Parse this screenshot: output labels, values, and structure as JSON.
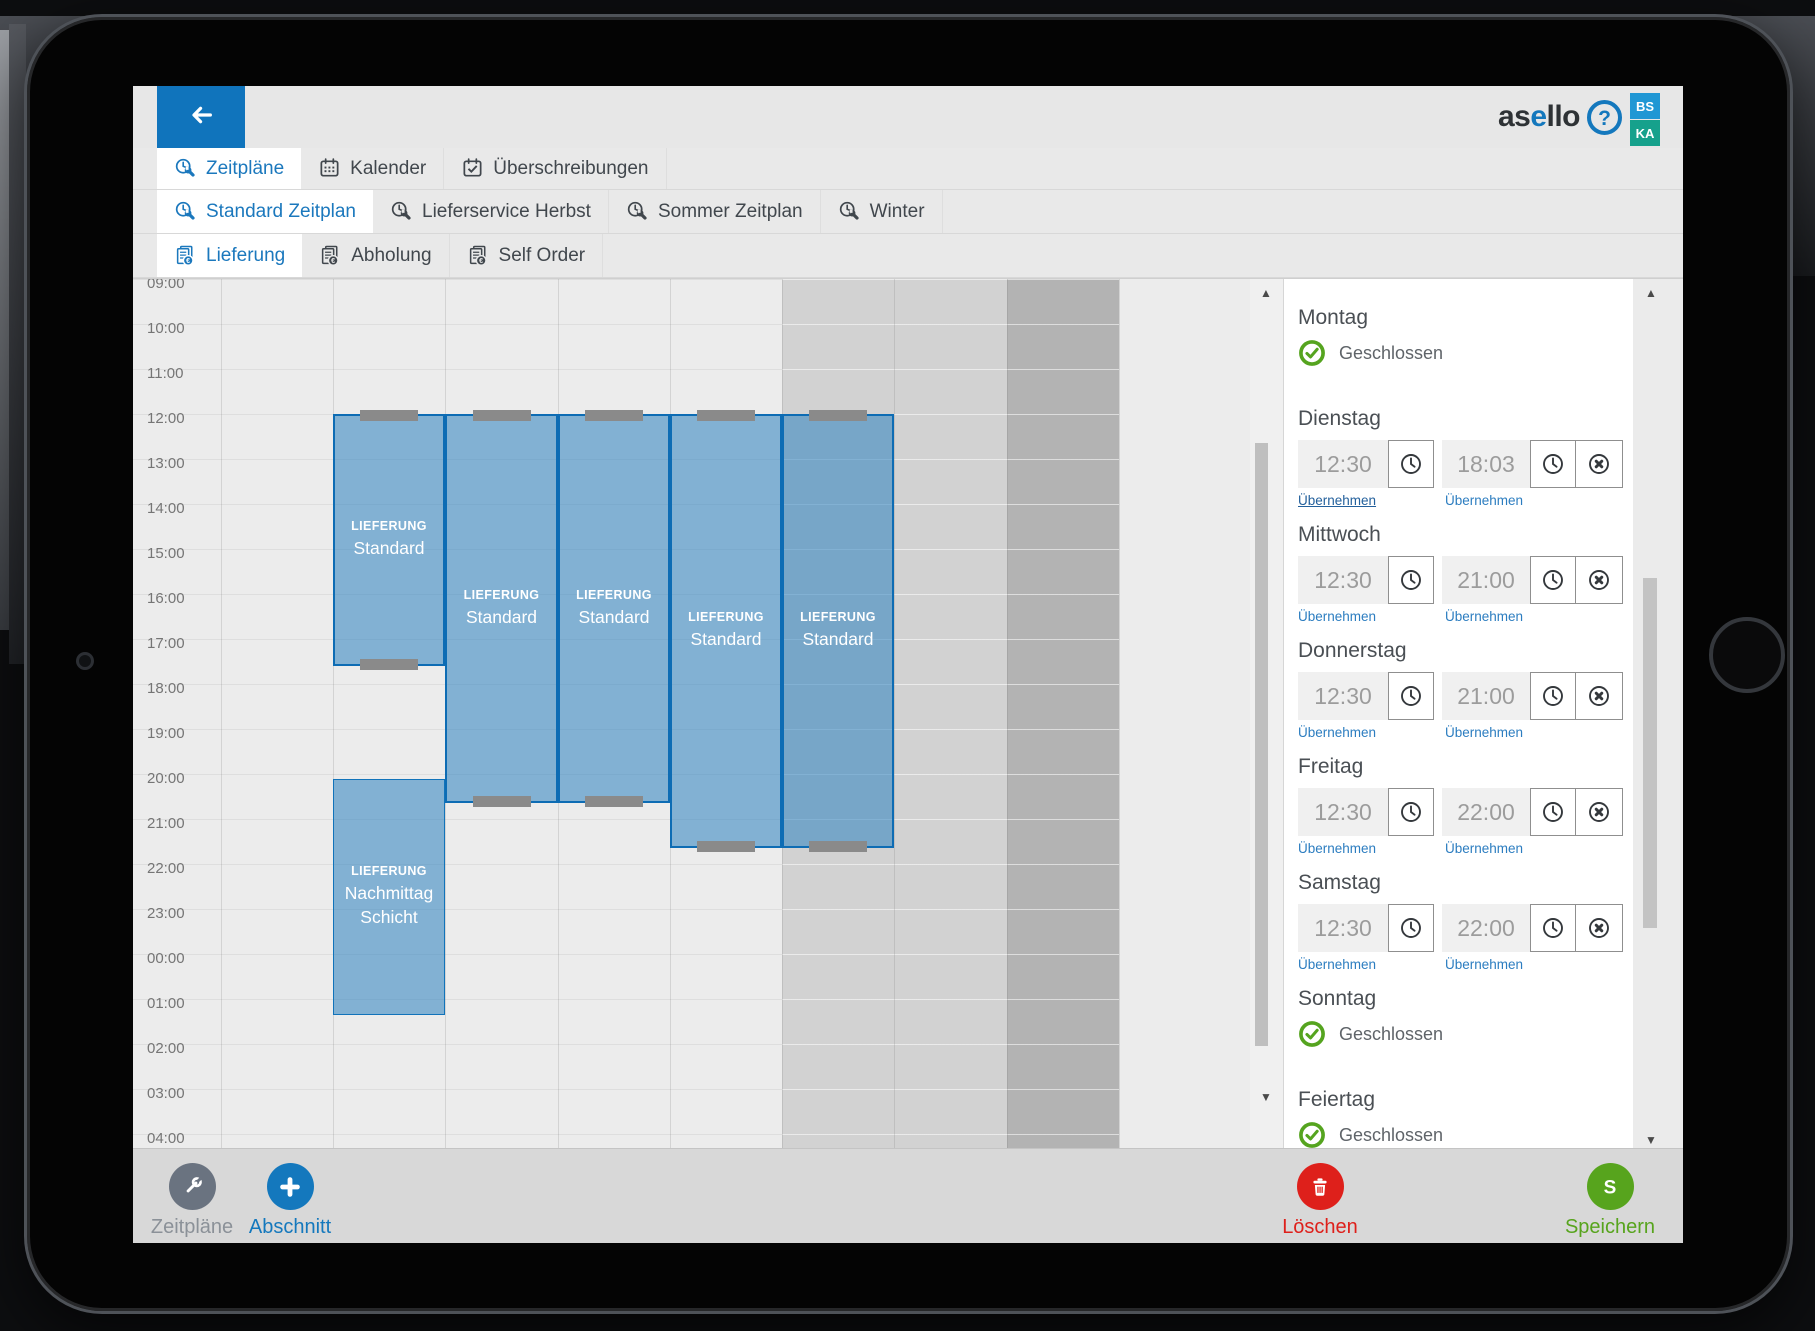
{
  "app": {
    "logo_pre": "as",
    "logo_accent": "e",
    "logo_post": "llo",
    "help_glyph": "?",
    "badges": [
      {
        "label": "BS",
        "color": "#2097d4"
      },
      {
        "label": "KA",
        "color": "#16a18c"
      }
    ],
    "accent_color": "#1478bd"
  },
  "nav_rows": [
    {
      "name": "view-tabs",
      "items": [
        {
          "label": "Zeitpläne",
          "icon": "clock-wrench",
          "active": true
        },
        {
          "label": "Kalender",
          "icon": "calendar",
          "active": false
        },
        {
          "label": "Überschreibungen",
          "icon": "calendar-check",
          "active": false
        }
      ]
    },
    {
      "name": "schedule-tabs",
      "items": [
        {
          "label": "Standard Zeitplan",
          "icon": "clock-wrench",
          "active": true
        },
        {
          "label": "Lieferservice Herbst",
          "icon": "clock-wrench",
          "active": false
        },
        {
          "label": "Sommer Zeitplan",
          "icon": "clock-wrench",
          "active": false
        },
        {
          "label": "Winter",
          "icon": "clock-wrench",
          "active": false
        }
      ]
    },
    {
      "name": "service-tabs",
      "items": [
        {
          "label": "Lieferung",
          "icon": "doc-euro",
          "active": true
        },
        {
          "label": "Abholung",
          "icon": "doc-euro",
          "active": false
        },
        {
          "label": "Self Order",
          "icon": "doc-euro",
          "active": false
        }
      ]
    }
  ],
  "calendar": {
    "time_labels": [
      "09:00",
      "10:00",
      "11:00",
      "12:00",
      "13:00",
      "14:00",
      "15:00",
      "16:00",
      "17:00",
      "18:00",
      "19:00",
      "20:00",
      "21:00",
      "22:00",
      "23:00",
      "00:00",
      "01:00",
      "02:00",
      "03:00",
      "04:00"
    ],
    "day_columns": [
      "Montag",
      "Dienstag",
      "Mittwoch",
      "Donnerstag",
      "Freitag",
      "Samstag",
      "Sonntag",
      "Feiertag"
    ],
    "weekend_columns": [
      5,
      6
    ],
    "holiday_columns": [
      7
    ],
    "blocks": [
      {
        "day": "Dienstag",
        "col": 1,
        "start_hour": 12.0,
        "end_hour": 17.6,
        "category": "LIEFERUNG",
        "name": "Standard",
        "selected": true,
        "handles": [
          "top",
          "bottom"
        ]
      },
      {
        "day": "Mittwoch",
        "col": 2,
        "start_hour": 12.0,
        "end_hour": 20.65,
        "category": "LIEFERUNG",
        "name": "Standard",
        "selected": true,
        "handles": [
          "top",
          "bottom"
        ]
      },
      {
        "day": "Donnerstag",
        "col": 3,
        "start_hour": 12.0,
        "end_hour": 20.65,
        "category": "LIEFERUNG",
        "name": "Standard",
        "selected": true,
        "handles": [
          "top",
          "bottom"
        ]
      },
      {
        "day": "Freitag",
        "col": 4,
        "start_hour": 12.0,
        "end_hour": 21.65,
        "category": "LIEFERUNG",
        "name": "Standard",
        "selected": true,
        "handles": [
          "top",
          "bottom"
        ]
      },
      {
        "day": "Samstag",
        "col": 5,
        "start_hour": 12.0,
        "end_hour": 21.65,
        "category": "LIEFERUNG",
        "name": "Standard",
        "selected": true,
        "handles": [
          "top",
          "bottom"
        ]
      },
      {
        "day": "Dienstag",
        "col": 1,
        "start_hour": 20.1,
        "end_hour": 25.35,
        "category": "LIEFERUNG",
        "name": "Nachmittag Schicht",
        "selected": false,
        "handles": []
      }
    ],
    "block_fill": "rgba(43,129,192,0.55)",
    "block_border": "#0d6cb4"
  },
  "panel": {
    "closed_label": "Geschlossen",
    "apply_label": "Übernehmen",
    "status_green": "#55a41f",
    "days": [
      {
        "name": "Montag",
        "closed": true
      },
      {
        "name": "Dienstag",
        "from": "12:30",
        "to": "18:03",
        "emphasize_first_link": true
      },
      {
        "name": "Mittwoch",
        "from": "12:30",
        "to": "21:00"
      },
      {
        "name": "Donnerstag",
        "from": "12:30",
        "to": "21:00"
      },
      {
        "name": "Freitag",
        "from": "12:30",
        "to": "22:00"
      },
      {
        "name": "Samstag",
        "from": "12:30",
        "to": "22:00"
      },
      {
        "name": "Sonntag",
        "closed": true
      },
      {
        "name": "Feiertag",
        "closed": true
      }
    ]
  },
  "footer": {
    "left": [
      {
        "label": "Zeitpläne",
        "icon": "wrench",
        "circle_color": "#6a7380",
        "label_color": "#8b9198"
      },
      {
        "label": "Abschnitt",
        "icon": "plus",
        "circle_color": "#1478bd",
        "label_color": "#1478bd"
      }
    ],
    "right": [
      {
        "label": "Löschen",
        "icon": "trash",
        "circle_color": "#de201b",
        "label_color": "#de201b",
        "center_x": 1187
      },
      {
        "label": "Speichern",
        "icon": "letter-s",
        "circle_color": "#57a41d",
        "label_color": "#57a41d",
        "center_x": 1477
      }
    ]
  }
}
